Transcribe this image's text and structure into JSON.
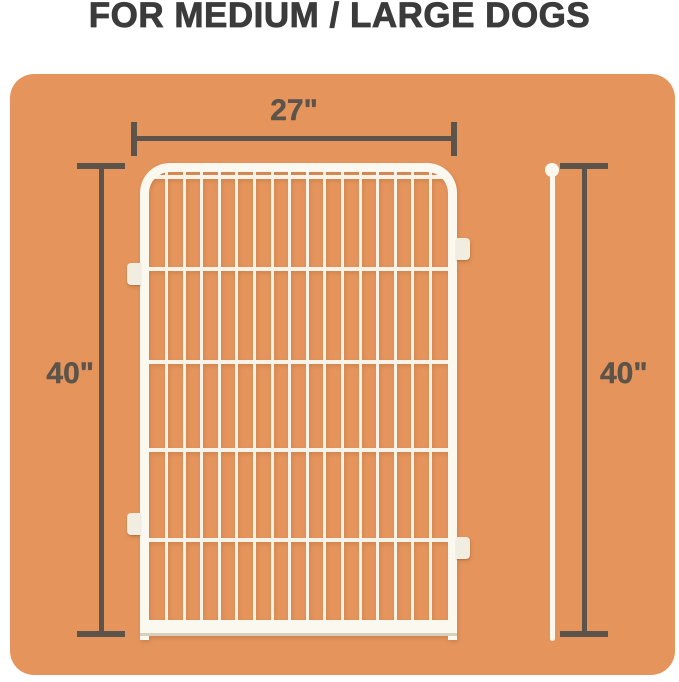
{
  "title": "FOR MEDIUM / LARGE DOGS",
  "dimensions": {
    "width_label": "27\"",
    "height_left_label": "40\"",
    "height_right_label": "40\""
  },
  "fence": {
    "vertical_wire_count": 16,
    "horizontal_wire_offsets_px": [
      12,
      104,
      197,
      285,
      375
    ]
  },
  "colors": {
    "background_panel": "#E5955C",
    "dimension_lines": "#5C544A",
    "title_text": "#3B3B3B",
    "fence_frame": "#FBF8F0",
    "fence_wires": "#F7F3E9",
    "mounting_tabs": "#F2EDE1",
    "bottom_shadow": "#D8D0BD"
  }
}
